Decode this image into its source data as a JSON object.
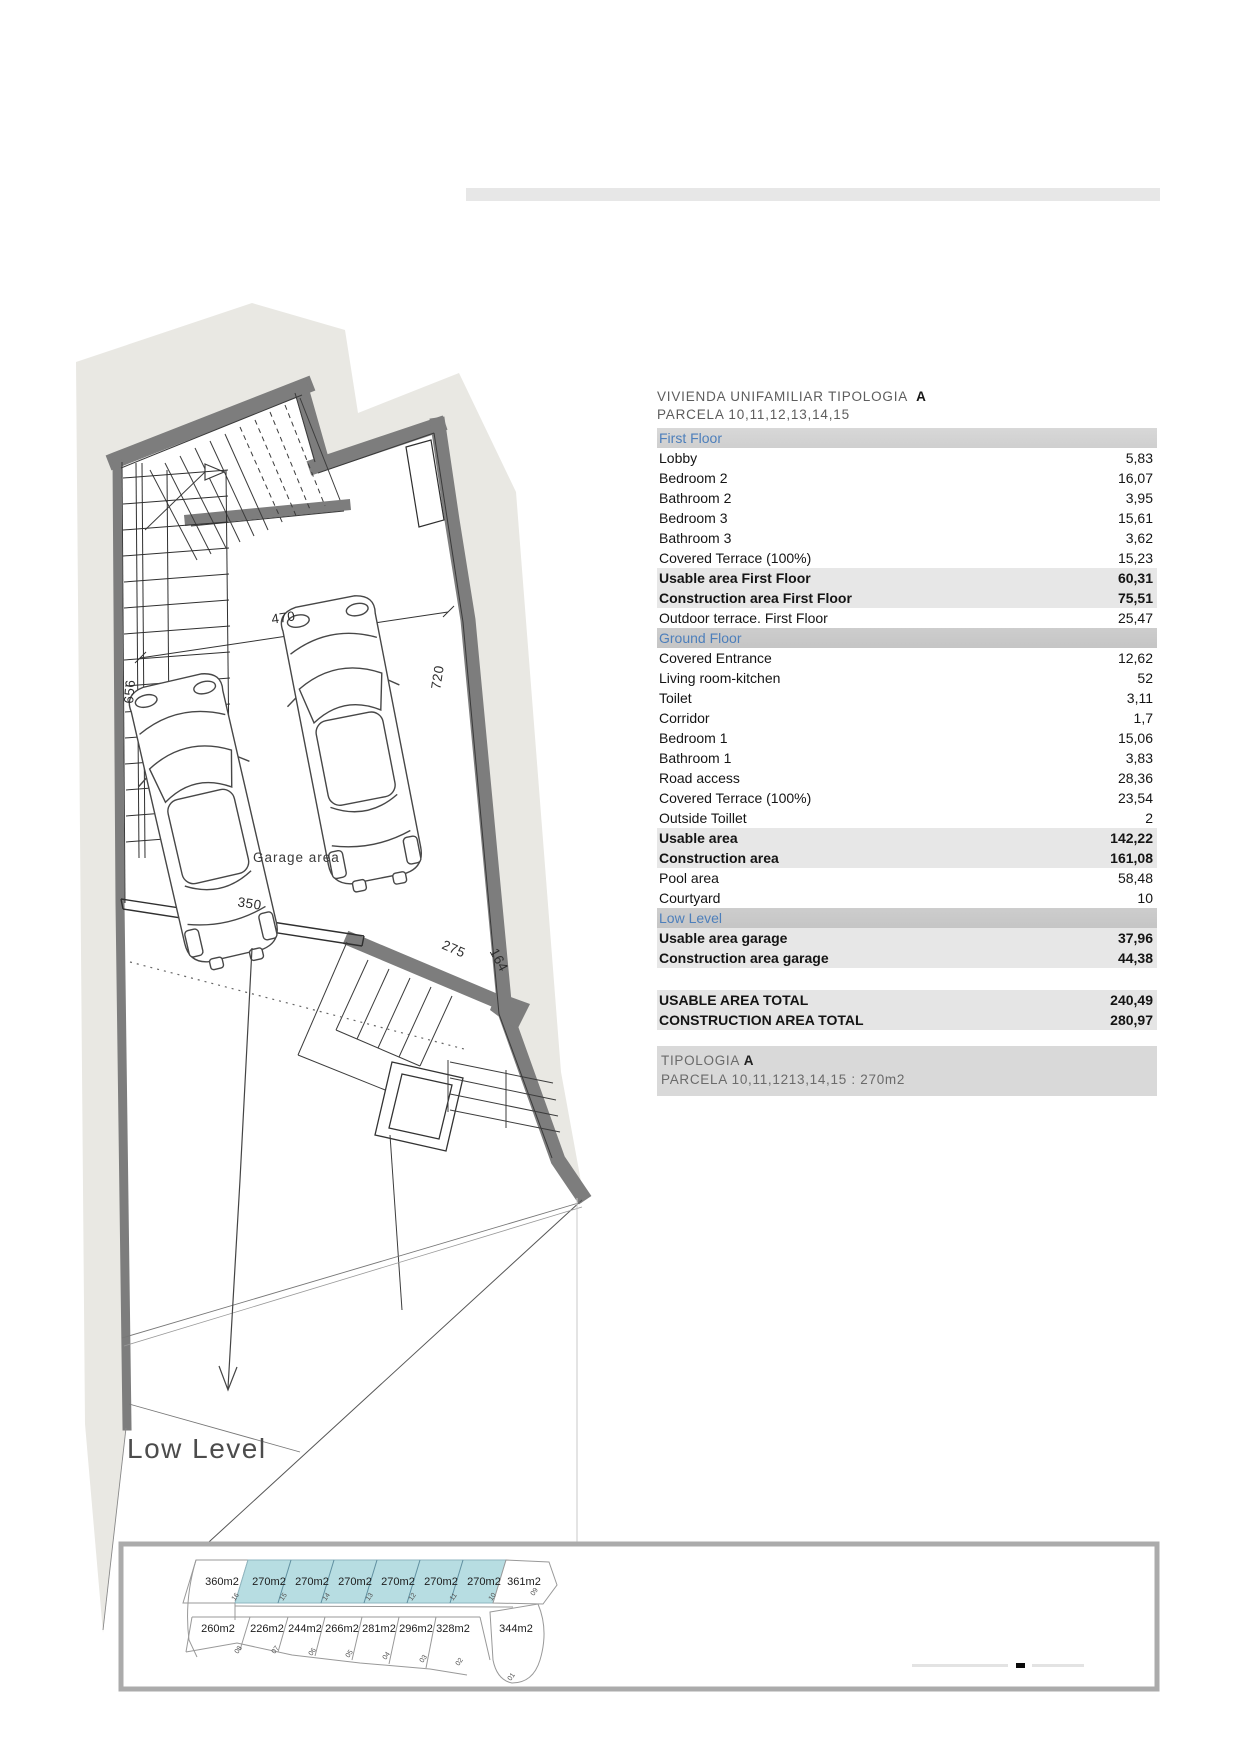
{
  "table": {
    "title": "VIVIENDA UNIFAMILIAR TIPOLOGIA",
    "title_em": "A",
    "subtitle": "PARCELA 10,11,12,13,14,15",
    "rows": [
      {
        "label": "First Floor",
        "value": ""
      },
      {
        "label": "Lobby",
        "value": "5,83"
      },
      {
        "label": "Bedroom 2",
        "value": "16,07"
      },
      {
        "label": "Bathroom 2",
        "value": "3,95"
      },
      {
        "label": "Bedroom 3",
        "value": "15,61"
      },
      {
        "label": "Bathroom 3",
        "value": "3,62"
      },
      {
        "label": "Covered Terrace (100%)",
        "value": "15,23"
      },
      {
        "label": "Usable area First Floor",
        "value": "60,31"
      },
      {
        "label": "Construction area First Floor",
        "value": "75,51"
      },
      {
        "label": "Outdoor terrace.  First Floor",
        "value": "25,47"
      },
      {
        "label": "Ground Floor",
        "value": ""
      },
      {
        "label": "Covered Entrance",
        "value": "12,62"
      },
      {
        "label": "Living room-kitchen",
        "value": "52"
      },
      {
        "label": "Toilet",
        "value": "3,11"
      },
      {
        "label": "Corridor",
        "value": "1,7"
      },
      {
        "label": "Bedroom 1",
        "value": "15,06"
      },
      {
        "label": "Bathroom 1",
        "value": "3,83"
      },
      {
        "label": "Road access",
        "value": "28,36"
      },
      {
        "label": "Covered Terrace (100%)",
        "value": "23,54"
      },
      {
        "label": "Outside Toillet",
        "value": "2"
      },
      {
        "label": "Usable area",
        "value": "142,22"
      },
      {
        "label": "Construction area",
        "value": "161,08"
      },
      {
        "label": "Pool area",
        "value": "58,48"
      },
      {
        "label": "Courtyard",
        "value": "10"
      },
      {
        "label": "Low Level",
        "value": ""
      },
      {
        "label": "Usable area garage",
        "value": "37,96"
      },
      {
        "label": "Construction area garage",
        "value": "44,38"
      }
    ],
    "totals": [
      {
        "label": "USABLE AREA TOTAL",
        "value": "240,49"
      },
      {
        "label": "CONSTRUCTION AREA TOTAL",
        "value": "280,97"
      }
    ],
    "footer": {
      "line1": "TIPOLOGIA",
      "line1_em": "A",
      "line2": "PARCELA 10,11,1213,14,15  : 270m2"
    }
  },
  "plan": {
    "garage_label": "Garage area",
    "level_label": "Low Level",
    "dims": {
      "garage_width": "470",
      "right_wall": "720",
      "left_wall": "656",
      "bottom_wall": "350",
      "diag_wall": "275",
      "short_wall": "164"
    }
  },
  "site_strip": {
    "top_row": [
      {
        "area": "360m2",
        "num": "16"
      },
      {
        "area": "270m2",
        "num": "15"
      },
      {
        "area": "270m2",
        "num": "14"
      },
      {
        "area": "270m2",
        "num": "13"
      },
      {
        "area": "270m2",
        "num": "12"
      },
      {
        "area": "270m2",
        "num": "11"
      },
      {
        "area": "270m2",
        "num": "10"
      },
      {
        "area": "361m2",
        "num": "09"
      }
    ],
    "bottom_row": [
      {
        "area": "260m2",
        "num": "08"
      },
      {
        "area": "226m2",
        "num": "07"
      },
      {
        "area": "244m2",
        "num": "06"
      },
      {
        "area": "266m2",
        "num": "05"
      },
      {
        "area": "281m2",
        "num": "04"
      },
      {
        "area": "296m2",
        "num": "03"
      },
      {
        "area": "328m2",
        "num": "02"
      },
      {
        "area": "344m2",
        "num": "01"
      }
    ],
    "highlight_color": "#b7dde2"
  }
}
